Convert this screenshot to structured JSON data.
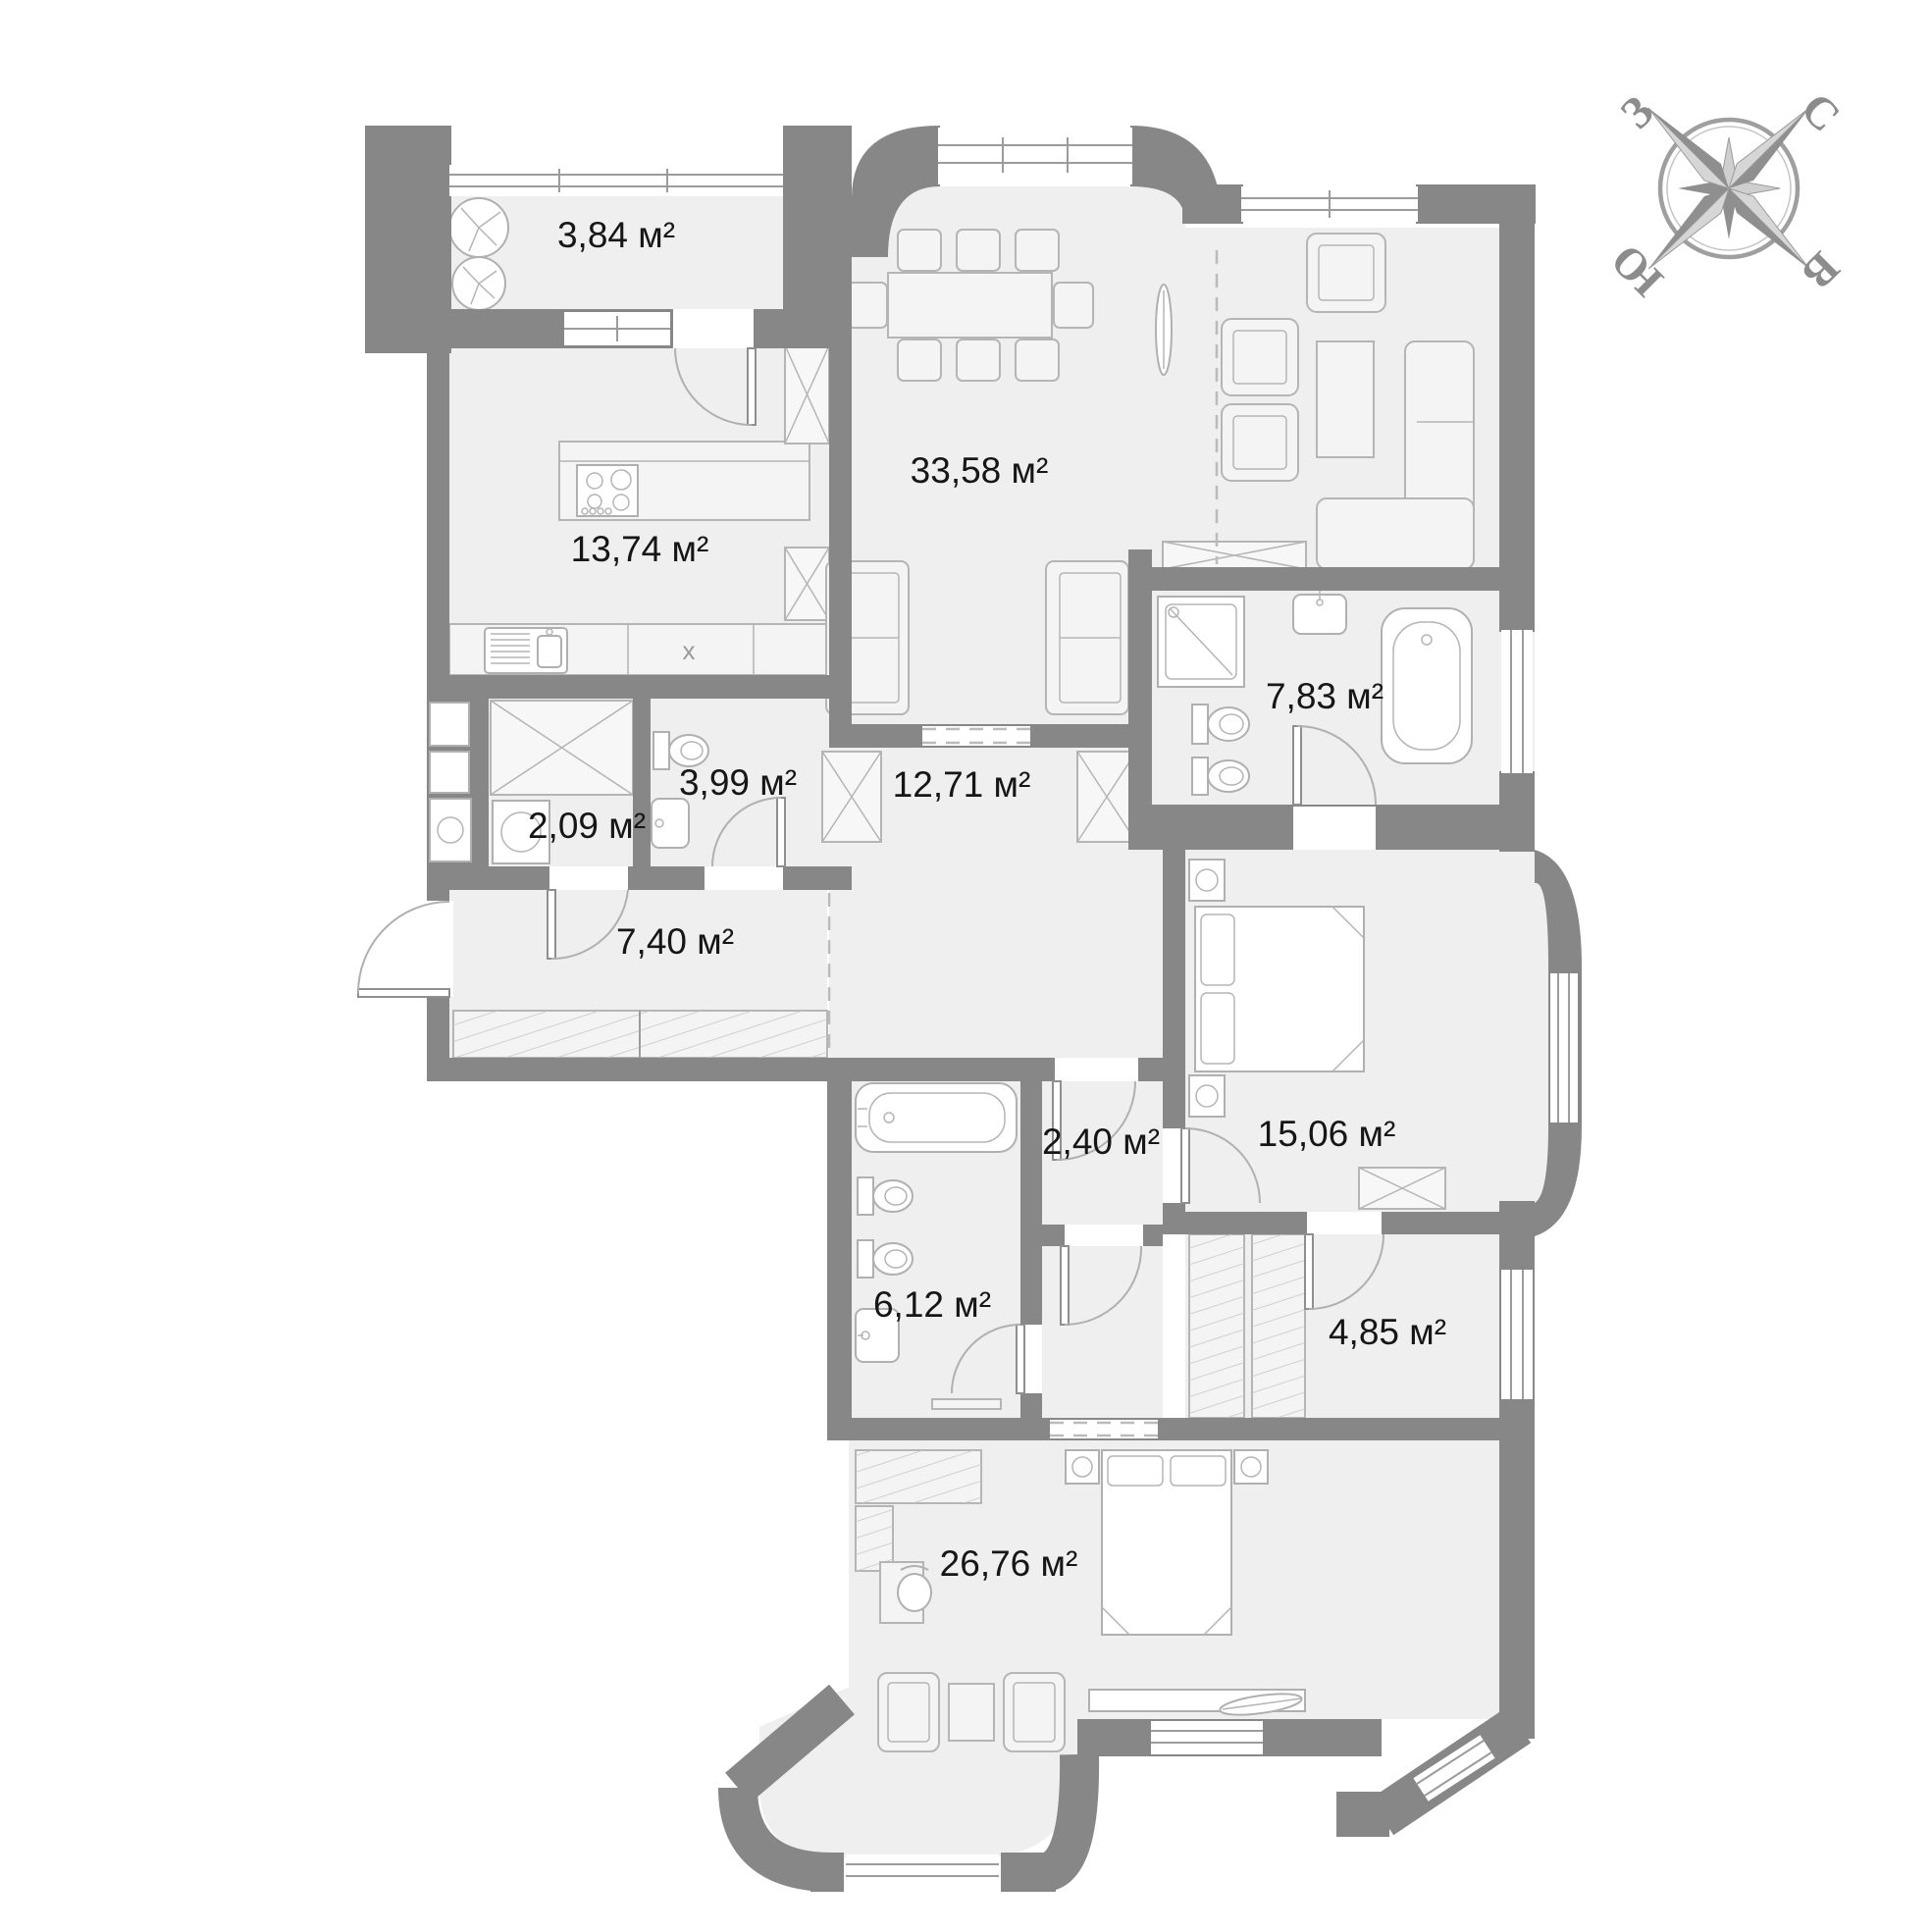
{
  "compass": {
    "north": "С",
    "east": "В",
    "south": "Ю",
    "west": "З"
  },
  "markers": {
    "shaft": "x"
  },
  "rooms": [
    {
      "id": "balcony",
      "label": "3,84 м²"
    },
    {
      "id": "kitchen",
      "label": "13,74 м²"
    },
    {
      "id": "dining-living",
      "label": "33,58 м²"
    },
    {
      "id": "bathroom-main",
      "label": "7,83 м²"
    },
    {
      "id": "wc",
      "label": "3,99 м²"
    },
    {
      "id": "laundry",
      "label": "2,09 м²"
    },
    {
      "id": "hall-central",
      "label": "12,71 м²"
    },
    {
      "id": "entry-hall",
      "label": "7,40 м²"
    },
    {
      "id": "bedroom",
      "label": "15,06 м²"
    },
    {
      "id": "closet",
      "label": "2,40 м²"
    },
    {
      "id": "bathroom-second",
      "label": "6,12 м²"
    },
    {
      "id": "dressing-room",
      "label": "4,85 м²"
    },
    {
      "id": "bedroom-master",
      "label": "26,76 м²"
    }
  ]
}
